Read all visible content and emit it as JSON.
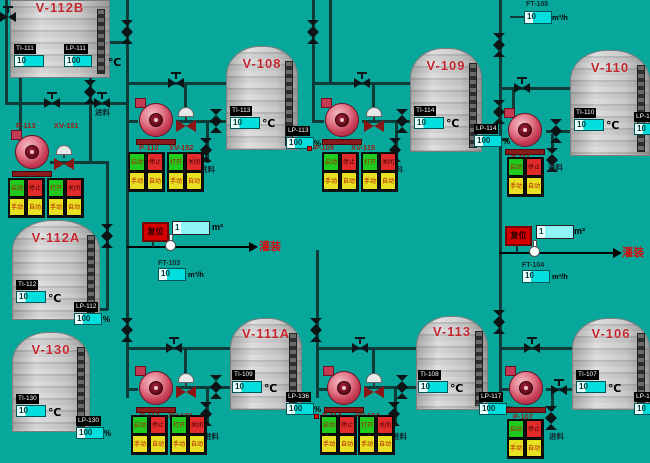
{
  "screen": {
    "background": "#08a79c",
    "pipe_color": "#0b3c38",
    "accent_red": "#cc1111",
    "value_cyan": "#00dede"
  },
  "tanks": [
    {
      "name": "V-112B",
      "ti_label": "TI-111",
      "ti_value": "10",
      "ti_unit": "℃",
      "lp_label": "LP-111",
      "lp_value": "100",
      "lp_unit": ""
    },
    {
      "name": "V-108",
      "ti_label": "TI-113",
      "ti_value": "10",
      "ti_unit": "℃",
      "lp_label": "LP-113",
      "lp_value": "100",
      "lp_unit": "%"
    },
    {
      "name": "V-109",
      "ti_label": "TI-114",
      "ti_value": "10",
      "ti_unit": "℃",
      "lp_label": "LP-114",
      "lp_value": "100",
      "lp_unit": "%"
    },
    {
      "name": "V-110",
      "ti_label": "TI-110",
      "ti_value": "10",
      "ti_unit": "℃",
      "lp_label": "LP-1",
      "lp_value": "10",
      "lp_unit": ""
    },
    {
      "name": "V-112A",
      "ti_label": "TI-112",
      "ti_value": "10",
      "ti_unit": "℃",
      "lp_label": "LP-112",
      "lp_value": "100",
      "lp_unit": "%"
    },
    {
      "name": "V-130",
      "ti_label": "TI-130",
      "ti_value": "10",
      "ti_unit": "℃",
      "lp_label": "LP-130",
      "lp_value": "100",
      "lp_unit": "%"
    },
    {
      "name": "V-111A",
      "ti_label": "TI-109",
      "ti_value": "10",
      "ti_unit": "℃",
      "lp_label": "LP-136",
      "lp_value": "100",
      "lp_unit": "%"
    },
    {
      "name": "V-113",
      "ti_label": "TI-108",
      "ti_value": "10",
      "ti_unit": "℃",
      "lp_label": "LP-117",
      "lp_value": "100",
      "lp_unit": "%"
    },
    {
      "name": "V-106",
      "ti_label": "TI-107",
      "ti_value": "10",
      "ti_unit": "℃",
      "lp_label": "LP-1",
      "lp_value": "10",
      "lp_unit": ""
    }
  ],
  "groups": [
    {
      "pump": "P-113",
      "valve": "XV-151",
      "feed": "进料"
    },
    {
      "pump": "P-110",
      "valve": "XV-152",
      "feed": "进料"
    },
    {
      "pump": "P-109",
      "valve": "XV-115",
      "feed": "进料"
    },
    {
      "pump": "P-111",
      "feed": "进料"
    },
    {
      "pump": "P-112",
      "valve": "XV-120",
      "feed": "进料"
    },
    {
      "pump": "P-114",
      "valve": "XV-154",
      "feed": "进料"
    },
    {
      "pump": "P-107",
      "feed": "进料"
    }
  ],
  "flow_meters": [
    {
      "label": "FT-103",
      "value": "10",
      "unit": "m³/h"
    },
    {
      "label": "FT-104",
      "value": "10",
      "unit": "m³/h"
    },
    {
      "label": "FT-105",
      "value": "10",
      "unit": "m³/h"
    }
  ],
  "totalizers": [
    {
      "value": "1",
      "unit": "m³"
    },
    {
      "value": "1",
      "unit": "m³"
    }
  ],
  "reset_buttons": [
    {
      "label": "复位"
    },
    {
      "label": "复位"
    }
  ],
  "arrows": [
    {
      "label": "灌装"
    },
    {
      "label": "灌装"
    }
  ],
  "panel_buttons": {
    "pump": [
      "启动",
      "停止",
      "手动",
      "自动"
    ],
    "valve": [
      "打开",
      "关闭",
      "手动",
      "自动"
    ]
  }
}
